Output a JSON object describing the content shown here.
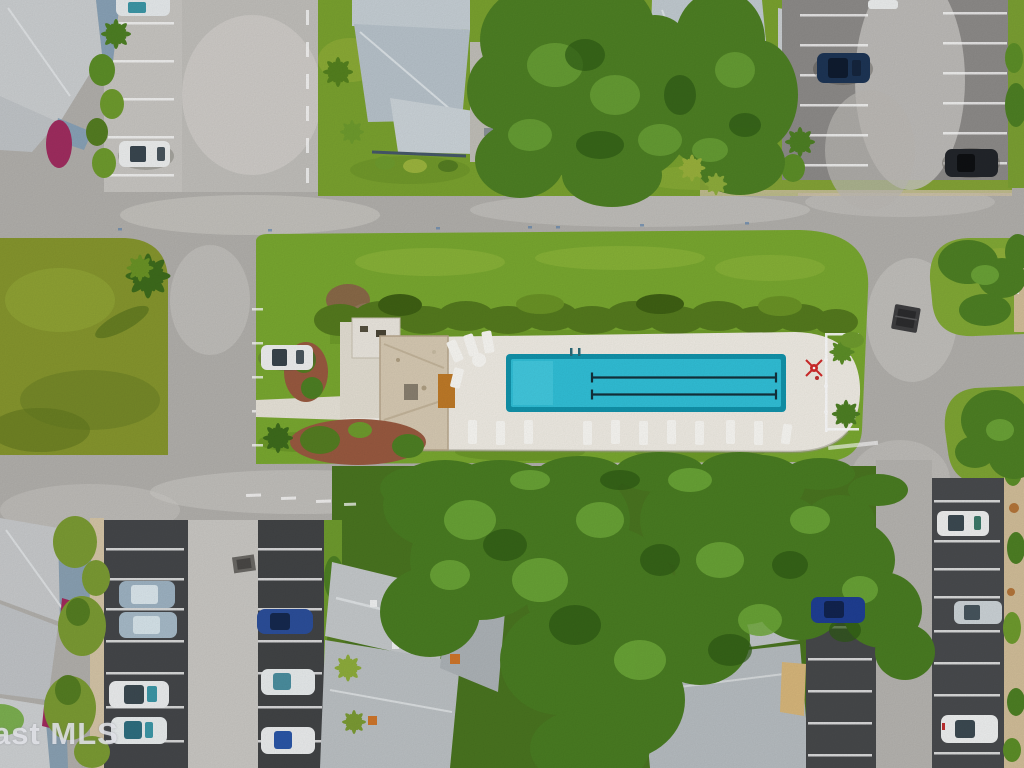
{
  "meta": {
    "type": "aerial-drone-photograph",
    "scene": "Top-down aerial view of a residential condo community with a long community lap pool, clubhouse, lawns, roads and parking lots",
    "watermark_text": "ast MLS"
  },
  "pool_area": {
    "pool_water_color": "#31c1d9",
    "pool_rim_color": "#1294ac",
    "lane_lines_visible": 2,
    "deck_color": "#f2eee6",
    "clubhouse_roof_color": "#d8cbb4",
    "features": [
      "rectangular lap pool",
      "white lounge chairs",
      "white pool fence",
      "red umbrella",
      "red mulch garden beds",
      "hedge row",
      "rock cluster"
    ]
  },
  "vehicles": {
    "count": 16,
    "visible_colors": [
      "white",
      "silver",
      "light blue",
      "dark blue",
      "black",
      "teal"
    ]
  },
  "environment": {
    "grass_color": "#7aa930",
    "road_color": "#b5b3af",
    "dark_parking_asphalt_color": "#45474a",
    "roof_color": "#c4cbd0",
    "tree_canopy_color": "#4e8024",
    "magenta_flora_color": "#a12d60",
    "sand_walkway_color": "#d3bf9a"
  }
}
